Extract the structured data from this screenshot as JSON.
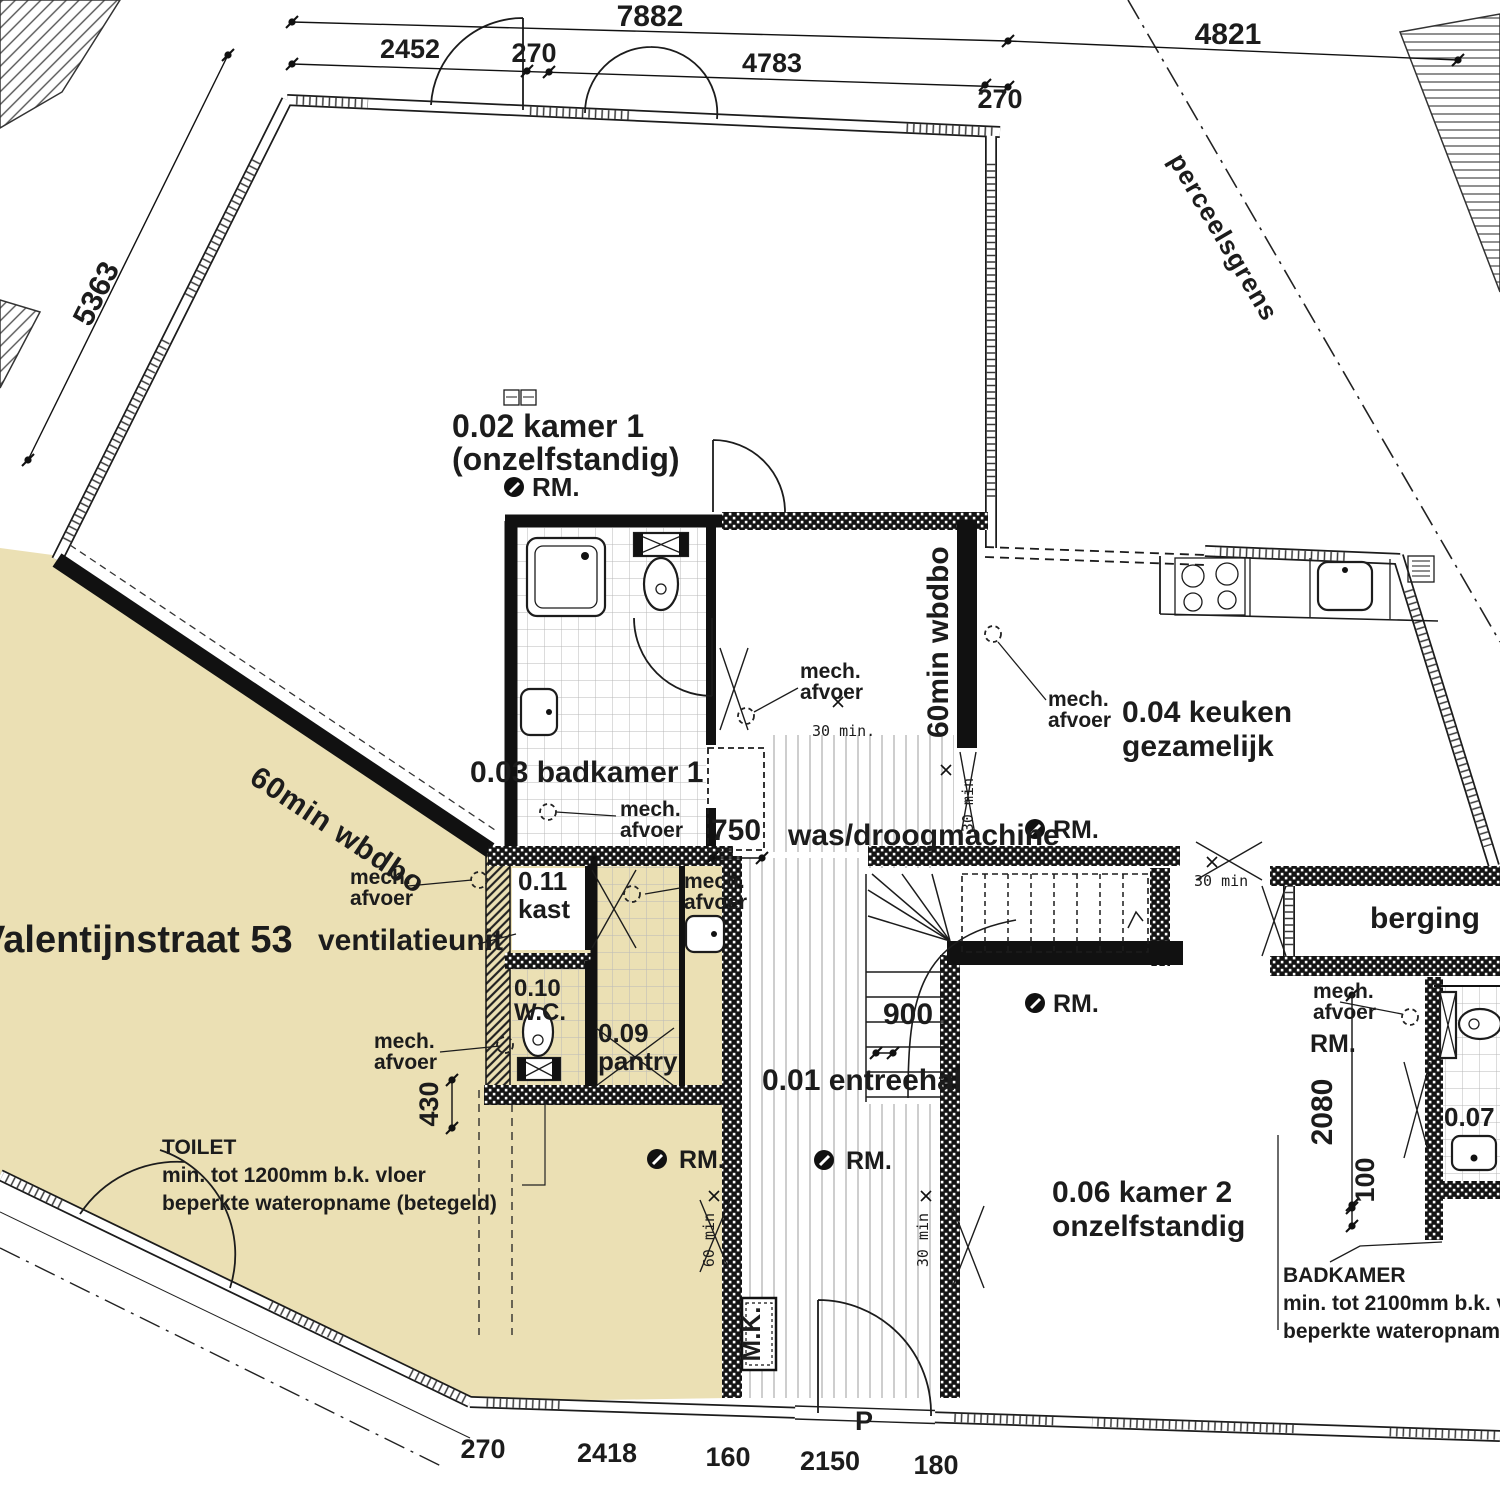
{
  "colors": {
    "existing": "#ebe0b4",
    "ink": "#1c1c1c",
    "paper": "#ffffff"
  },
  "site": {
    "street": "Valentijnstraat 53",
    "parcel": "perceelsgrens",
    "marker_p": "P"
  },
  "rooms": {
    "entreehal": "0.01 entreehal",
    "kamer1_l1": "0.02 kamer 1",
    "kamer1_l2": "(onzelfstandig)",
    "badkamer1": "0.03 badkamer 1",
    "keuken_l1": "0.04 keuken",
    "keuken_l2": "gezamelijk",
    "kamer2_l1": "0.06 kamer 2",
    "kamer2_l2": "onzelfstandig",
    "badkamer2": "0.07",
    "pantry_l1": "0.09",
    "pantry_l2": "pantry",
    "wc_l1": "0.10",
    "wc_l2": "W.C.",
    "kast_l1": "0.11",
    "kast_l2": "kast",
    "berging": "berging"
  },
  "ann": {
    "fire60": "60min wbdbo",
    "min30": "30 min",
    "min30d": "30 min.",
    "min60": "60 min",
    "vent": "ventilatieunit",
    "washer": "was/droogmachine",
    "mk": "M.K.",
    "rm": "RM.",
    "mech_l1": "mech.",
    "mech_l2": "afvoer",
    "toilet_note": [
      "TOILET",
      "min. tot 1200mm b.k. vloer",
      "beperkte wateropname (betegeld)"
    ],
    "bath_note": [
      "BADKAMER",
      "min. tot 2100mm b.k. vloer",
      "beperkte wateropname (betegeld)"
    ]
  },
  "dims": {
    "top_total": "7882",
    "top_right": "4821",
    "left_diag": "5363",
    "top_segments": [
      "2452",
      "270",
      "4783",
      "270"
    ],
    "bottom_segments": [
      "270",
      "2418",
      "160",
      "2150",
      "180"
    ],
    "niche": "750",
    "stair": "900",
    "shaft": "430",
    "kamer2_height": "2080",
    "offset": "100"
  }
}
